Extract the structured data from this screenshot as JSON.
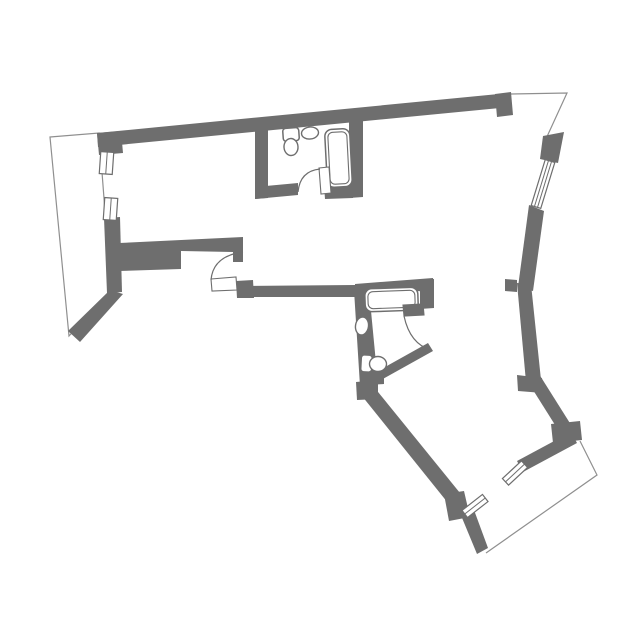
{
  "canvas": {
    "width": 644,
    "height": 635,
    "background": "#ffffff"
  },
  "colors": {
    "wall": "#6e6e6e",
    "outline": "#8f8f8f",
    "fixture_stroke": "#6e6e6e",
    "window_stroke": "#6e6e6e",
    "door_arc": "#6e6e6e",
    "white": "#ffffff"
  },
  "plan": {
    "walls": [
      {
        "name": "wall-top",
        "points": "97,133 509,93 510,107 98,147"
      },
      {
        "name": "wall-topleft-corner",
        "points": "97,133 121,131 123,153 99,155"
      },
      {
        "name": "wall-left-strip",
        "points": "104,218 120,217 122,292 107,293"
      },
      {
        "name": "wall-left-band",
        "points": "119,243 243,237 243,262 233,262 233,252 181,251 181,269 119,271"
      },
      {
        "name": "wall-left-diagonal",
        "points": "110,290 123,294 80,342 68,331"
      },
      {
        "name": "wall-door-block",
        "points": "236,281 253,280 254,298 237,298"
      },
      {
        "name": "wall-hall-south",
        "points": "237,286 355,285 355,297 237,297"
      },
      {
        "name": "wall-bath2-top",
        "points": "355,284 433,278 434,291 355,292"
      },
      {
        "name": "wall-bath2-right",
        "points": "420,280 434,279 434,308 420,309"
      },
      {
        "name": "wall-bath2-left",
        "points": "354,290 369,290 378,384 360,386"
      },
      {
        "name": "wall-bath2-notch",
        "points": "368,371 384,370 384,384 368,385"
      },
      {
        "name": "wall-bath2-bottom",
        "points": "367,377 428,343 433,351 372,385"
      },
      {
        "name": "wall-junction",
        "points": "356,382 378,380 378,399 357,400"
      },
      {
        "name": "wall-bedroom-west",
        "points": "362,396 374,387 460,493 448,503"
      },
      {
        "name": "wall-bedroom-sw-block",
        "points": "444,494 464,491 470,517 449,521"
      },
      {
        "name": "wall-bedroom-tip",
        "points": "460,513 474,510 488,548 477,554"
      },
      {
        "name": "wall-bedroom-se",
        "points": "517,461 571,432 577,443 523,472"
      },
      {
        "name": "wall-se-corner",
        "points": "551,424 580,421 582,440 553,443"
      },
      {
        "name": "wall-right-diagonal",
        "points": "528,382 539,374 573,428 562,436"
      },
      {
        "name": "wall-right-kink",
        "points": "517,375 542,378 543,393 518,391"
      },
      {
        "name": "wall-right-mid",
        "points": "517,283 531,284 541,380 526,382"
      },
      {
        "name": "wall-right-step",
        "points": "505,279 517,280 517,292 505,291"
      },
      {
        "name": "wall-right-upper",
        "points": "529,205 544,211 533,291 518,287"
      },
      {
        "name": "wall-window-block",
        "points": "543,136 564,132 558,163 540,159"
      },
      {
        "name": "wall-top-end-block",
        "points": "495,94 511,92 513,115 497,117"
      },
      {
        "name": "wall-bath1-left",
        "points": "255,125 268,124 268,198 255,199"
      },
      {
        "name": "wall-bath1-bottom-left",
        "points": "255,187 298,183 298,195 255,199"
      },
      {
        "name": "wall-bath1-bottom-right",
        "points": "323,171 352,168 353,198 325,199"
      },
      {
        "name": "wall-bath1-right",
        "points": "349,121 363,120 363,197 349,198"
      }
    ],
    "outlines": [
      {
        "name": "terrace-outline",
        "path": "M 50,137 L 99,133 L 111,290 L 69,336 Z"
      },
      {
        "name": "topright-edge-line",
        "path": "M 511,94 L 567,93 L 545,141"
      },
      {
        "name": "balcony-outline",
        "path": "M 580,441 L 597,475 L 486,553"
      }
    ],
    "windows": [
      {
        "name": "window-left-upper",
        "cx": 106.5,
        "cy": 163,
        "w": 13,
        "h": 22,
        "rot": 4,
        "lines": 1
      },
      {
        "name": "window-left-lower",
        "cx": 110.5,
        "cy": 209,
        "w": 13,
        "h": 22,
        "rot": 4,
        "lines": 1
      },
      {
        "name": "window-right",
        "cx": 543,
        "cy": 184,
        "w": 10,
        "h": 48,
        "rot": 17,
        "lines": 2
      },
      {
        "name": "window-bedroom-sw",
        "cx": 475,
        "cy": 506,
        "w": 26,
        "h": 9,
        "rot": -38,
        "lines": 1
      },
      {
        "name": "window-bedroom-se",
        "cx": 515,
        "cy": 473,
        "w": 26,
        "h": 9,
        "rot": -43,
        "lines": 1
      }
    ],
    "doors": [
      {
        "name": "door-bath1",
        "leaf": "319,168 329,167 331,193 321,194",
        "leaf_fill": "#ffffff",
        "arc": "M 298,192 Q 300,171 320,169"
      },
      {
        "name": "door-hall",
        "leaf": "211,279 236,277 237,290 212,291",
        "leaf_fill": "#ffffff",
        "arc": "M 211,280 Q 213,256 243,252"
      },
      {
        "name": "door-bath2",
        "leaf": "403,305 423,304 424,315 404,316",
        "leaf_fill": "#6e6e6e",
        "arc": "M 404,316 Q 410,344 431,350"
      }
    ],
    "fixtures": [
      {
        "name": "bathtub-bath1",
        "type": "dualrect",
        "x": 326,
        "y": 129,
        "w": 25,
        "h": 58,
        "rx": 7,
        "inset": 3,
        "rot": -3
      },
      {
        "name": "toilet-tank-bath1",
        "type": "rect",
        "x": 283,
        "y": 128,
        "w": 16,
        "h": 13,
        "rx": 3,
        "rot": -4
      },
      {
        "name": "toilet-bowl-bath1",
        "type": "ellipse",
        "cx": 291,
        "cy": 147,
        "rx": 7,
        "ry": 8.5,
        "rot": -4
      },
      {
        "name": "sink-bath1",
        "type": "ellipse",
        "cx": 310,
        "cy": 133,
        "rx": 8.5,
        "ry": 6,
        "rot": -6
      },
      {
        "name": "bathtub-bath2",
        "type": "dualrect",
        "x": 365,
        "y": 288,
        "w": 53,
        "h": 23,
        "rx": 7,
        "inset": 3,
        "rot": -2
      },
      {
        "name": "sink-bath2",
        "type": "ellipse",
        "cx": 362,
        "cy": 326,
        "rx": 6.5,
        "ry": 9,
        "rot": 8
      },
      {
        "name": "toilet-tank-bath2",
        "type": "rect",
        "x": 361,
        "y": 355,
        "w": 11,
        "h": 17,
        "rx": 3,
        "rot": 3
      },
      {
        "name": "toilet-bowl-bath2",
        "type": "ellipse",
        "cx": 378,
        "cy": 364,
        "rx": 8.5,
        "ry": 7.5,
        "rot": 3
      }
    ]
  }
}
